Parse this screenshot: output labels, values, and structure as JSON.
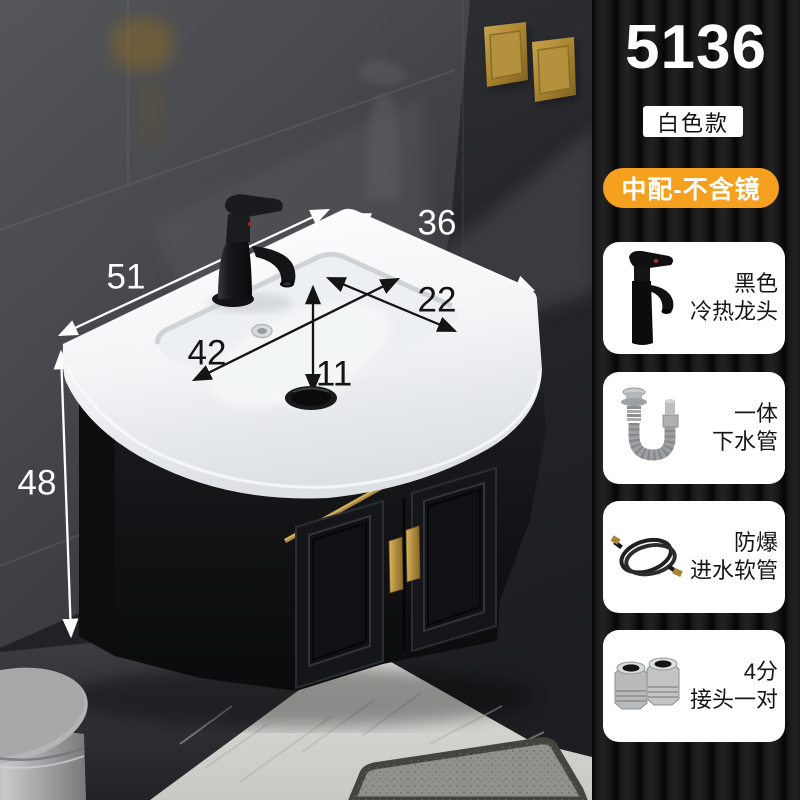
{
  "product": {
    "code": "5136",
    "variant_badge": "白色款",
    "config_badge": "中配-不含镜",
    "accessories": [
      {
        "icon": "faucet-icon",
        "line1": "黑色",
        "line2": "冷热龙头"
      },
      {
        "icon": "drain-pipe-icon",
        "line1": "一体",
        "line2": "下水管"
      },
      {
        "icon": "inlet-hose-icon",
        "line1": "防爆",
        "line2": "进水软管"
      },
      {
        "icon": "fitting-pair-icon",
        "line1": "4分",
        "line2": "接头一对"
      }
    ]
  },
  "dimensions": {
    "top_width": "51",
    "top_depth": "36",
    "basin_width": "42",
    "basin_depth": "22",
    "drain_offset": "11",
    "cabinet_height": "48"
  },
  "colors": {
    "accent_orange": "#F5A01F",
    "brass_gold": "#B08A3E",
    "card_bg": "#FFFFFF",
    "code_text": "#FFFFFF",
    "cabinet_black": "#121316",
    "porcelain_white": "#FAFBFC"
  }
}
